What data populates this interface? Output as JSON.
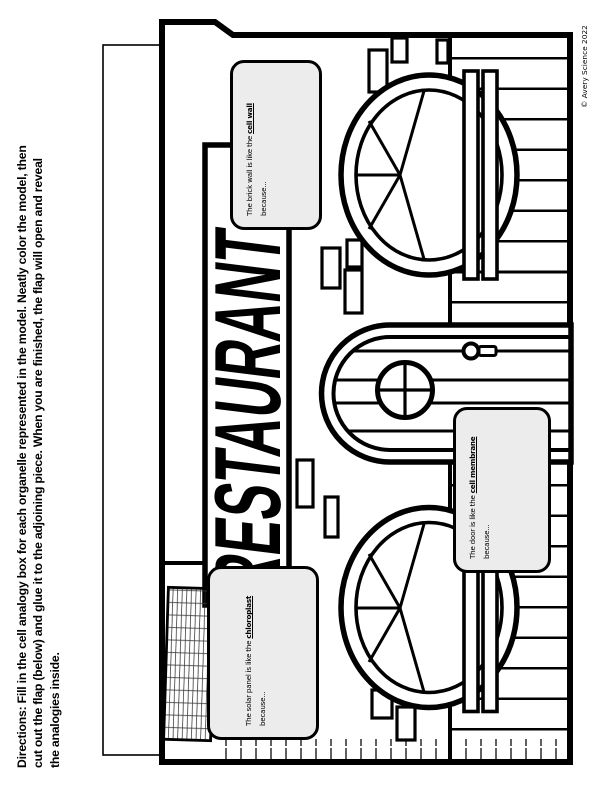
{
  "page": {
    "background": "#ffffff",
    "ink": "#000000",
    "flap_box_fill": "#ececec"
  },
  "directions": {
    "label": "Directions:",
    "line1_rest": " Fill in the cell analogy box for each organelle represented in the model. Neatly color the model, then",
    "line2": "cut out the flap (below) and glue it to the adjoining piece. When you are finished, the flap will open and reveal",
    "line3": "the analogies inside."
  },
  "sign": {
    "text": "RESTAURANT"
  },
  "analogy_boxes": [
    {
      "name": "brick-wall",
      "pre": "The brick wall is like the ",
      "term": "cell wall",
      "cont": "because..."
    },
    {
      "name": "solar-panel",
      "pre": "The solar panel is like the ",
      "term": "chloroplast",
      "cont": "because..."
    },
    {
      "name": "door",
      "pre": "The door is like the ",
      "term": "cell membrane",
      "cont": "because..."
    }
  ],
  "copyright": "© Avery Science 2022"
}
